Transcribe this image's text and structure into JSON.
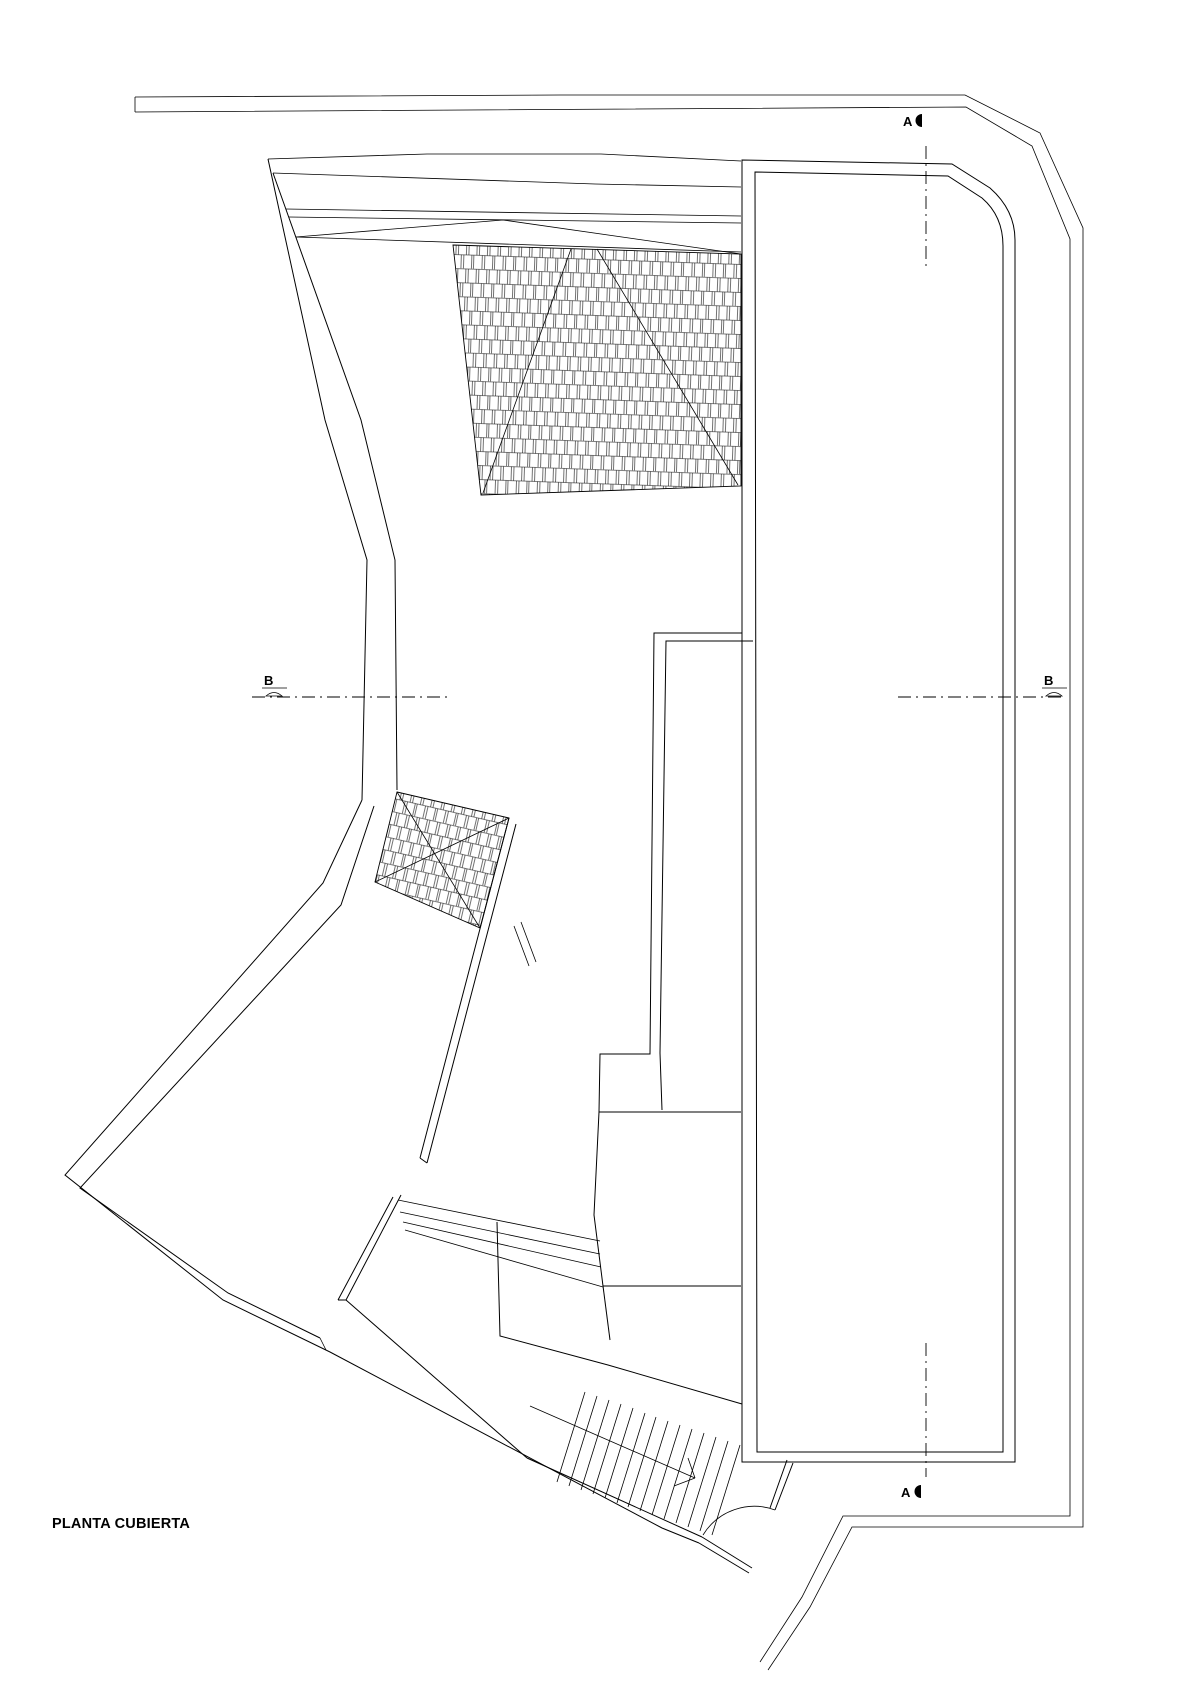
{
  "drawing": {
    "title": "PLANTA CUBIERTA",
    "type_label": "roof plan",
    "background_color": "#ffffff",
    "line_color": "#000000"
  },
  "section_markers": {
    "a_top": "A",
    "a_bottom": "A",
    "b_left": "B",
    "b_right": "B"
  }
}
